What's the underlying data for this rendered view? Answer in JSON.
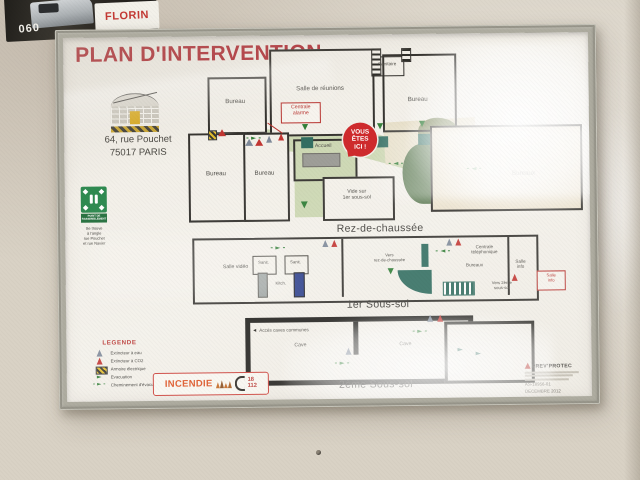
{
  "colors": {
    "accent_red": "#b8322e",
    "evac_green": "#2f7d35",
    "door_teal": "#2e6b5e",
    "sign_green": "#2e8a50",
    "frame_gray": "#aeaca0"
  },
  "scene": {
    "sticker_number": "060",
    "sticker_brand": "FLORIN"
  },
  "poster": {
    "title": "PLAN D'INTERVENTION",
    "address": {
      "line1": "64, rue Pouchet",
      "line2": "75017 PARIS"
    },
    "assembly": {
      "sign_label": "Point de rassemblement",
      "note_lines": [
        "Se trouve",
        "à l'angle",
        "rue Pouchet",
        "et rue Navier"
      ]
    },
    "ground": {
      "caption": "Rez-de-chaussée",
      "bureau_tl": "Bureau",
      "salle_reunions": "Salle de réunions",
      "sanitaire": "Sanitaire",
      "bureau_tr": "Bureau",
      "centrale_alarme": {
        "l1": "Centrale",
        "l2": "alarme"
      },
      "you_are_here": {
        "l1": "VOUS",
        "l2": "ÊTES",
        "l3": "ICI !"
      },
      "accueil": "Accueil",
      "bureau_bl1": "Bureau",
      "bureau_bl2": "Bureau",
      "vide": {
        "l1": "Vide sur",
        "l2": "1er sous-sol"
      },
      "bureaux_right": "Bureaux"
    },
    "b1": {
      "caption": "1er Sous-sol",
      "salle_video": "Salle vidéo",
      "sanit1": "Sanit.",
      "sanit2": "Sanit.",
      "kitch": "Kitch.",
      "vers_rdc": {
        "l1": "Vers",
        "l2": "rez-de-chaussée"
      },
      "centrale_tel": {
        "l1": "Centrale",
        "l2": "téléphonique"
      },
      "bureaux": "Bureaux",
      "salle_info": {
        "l1": "Salle",
        "l2": "info"
      },
      "vers_b2": {
        "l1": "Vers 2ème",
        "l2": "sous-sol"
      },
      "callout": {
        "l1": "Salle",
        "l2": "info"
      }
    },
    "b2": {
      "caption": "2ème Sous-sol",
      "acces": "Accès caves communes",
      "cave1": "Cave",
      "cave2": "Cave"
    },
    "legend": {
      "title": "LEGENDE",
      "items": [
        {
          "icon": "extinguisher-water-triangle",
          "label": "Extincteur à eau"
        },
        {
          "icon": "extinguisher-co2-triangle",
          "label": "Extincteur à CO2"
        },
        {
          "icon": "electrical-cabinet",
          "label": "Armoire électrique"
        },
        {
          "icon": "evacuation-arrow",
          "label": "Evacuation"
        },
        {
          "icon": "evacuation-route-dashed-arrow",
          "label": "Cheminement d'évacuation"
        }
      ]
    },
    "fire": {
      "label": "INCENDIE",
      "num1": "18",
      "num2": "112"
    },
    "publisher": {
      "name": "PREV'PROTEC",
      "ref": "AS-18956-01",
      "date": "DECEMBRE 2012"
    }
  }
}
